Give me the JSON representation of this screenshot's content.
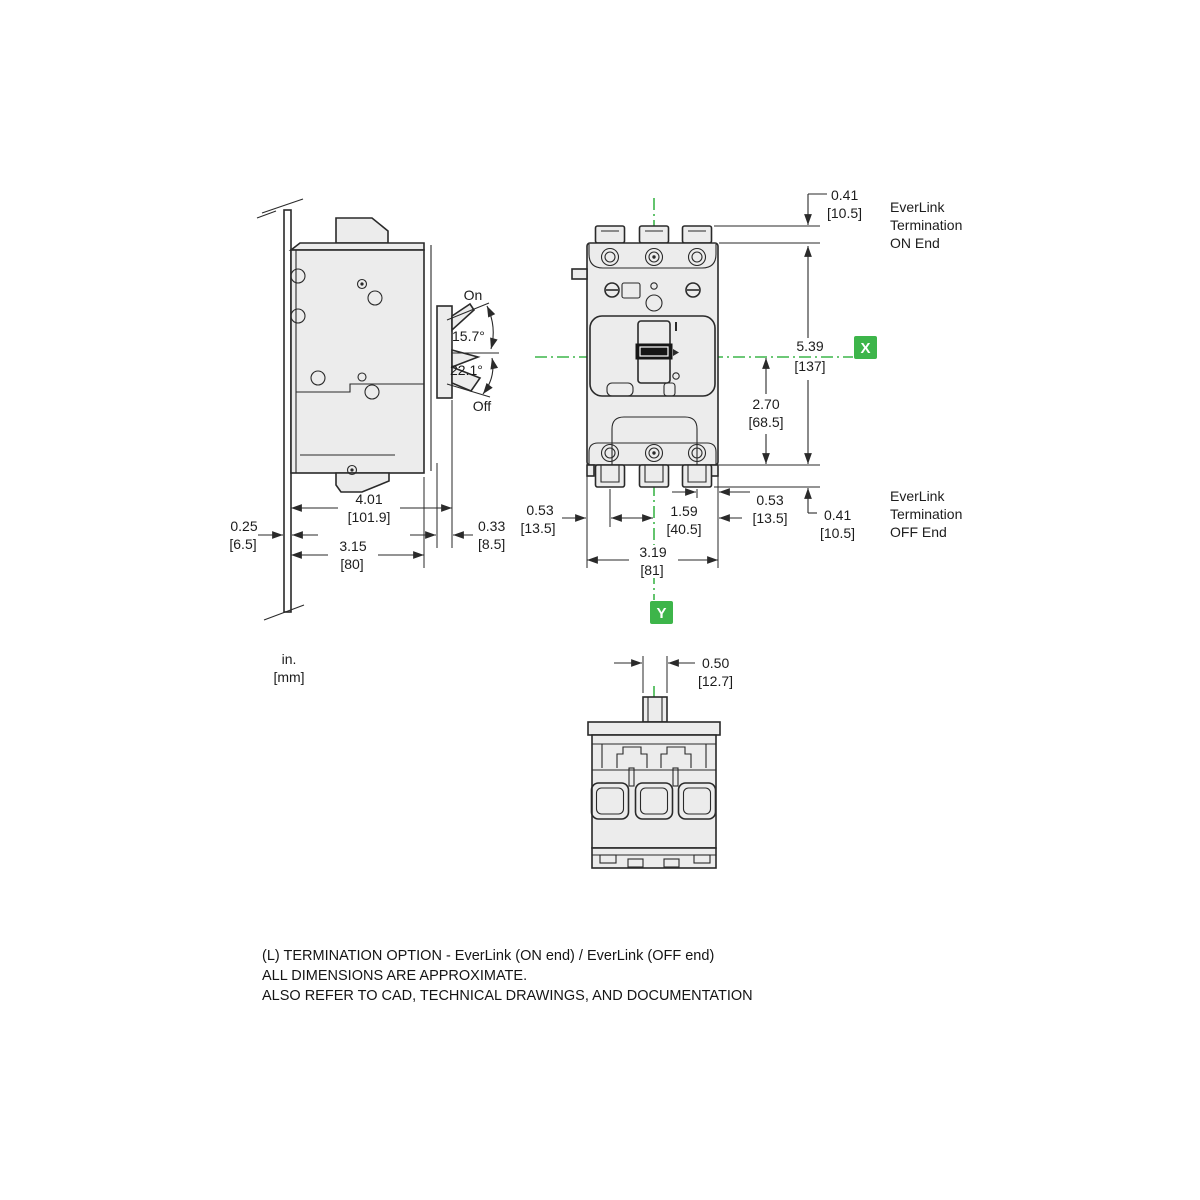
{
  "drawing": {
    "units_label": {
      "line1": "in.",
      "line2": "[mm]"
    },
    "side_view": {
      "handle_on_label": "On",
      "handle_off_label": "Off",
      "angle_on": "15.7°",
      "angle_off": "22.1°",
      "total_depth_in": "4.01",
      "total_depth_mm": "[101.9]",
      "panel_thickness_in": "0.25",
      "panel_thickness_mm": "[6.5]",
      "body_depth_in": "3.15",
      "body_depth_mm": "[80]",
      "escutcheon_depth_in": "0.33",
      "escutcheon_depth_mm": "[8.5]"
    },
    "front_view": {
      "tab_height_top_in": "0.41",
      "tab_height_top_mm": "[10.5]",
      "body_height_in": "5.39",
      "body_height_mm": "[137]",
      "center_to_bottom_in": "2.70",
      "center_to_bottom_mm": "[68.5]",
      "pole_offset_left_in": "0.53",
      "pole_offset_left_mm": "[13.5]",
      "pole_offset_right_in": "0.53",
      "pole_offset_right_mm": "[13.5]",
      "half_width_in": "1.59",
      "half_width_mm": "[40.5]",
      "body_width_in": "3.19",
      "body_width_mm": "[81]",
      "tab_height_bottom_in": "0.41",
      "tab_height_bottom_mm": "[10.5]",
      "axis_x_label": "X",
      "axis_y_label": "Y",
      "on_end_note": {
        "line1": "EverLink",
        "line2": "Termination",
        "line3": "ON End"
      },
      "off_end_note": {
        "line1": "EverLink",
        "line2": "Termination",
        "line3": "OFF End"
      }
    },
    "bottom_view": {
      "handle_width_in": "0.50",
      "handle_width_mm": "[12.7]"
    },
    "footer": {
      "line1": "(L) TERMINATION OPTION - EverLink (ON end) / EverLink (OFF end)",
      "line2": "ALL DIMENSIONS ARE APPROXIMATE.",
      "line3": "ALSO REFER TO CAD, TECHNICAL DRAWINGS, AND DOCUMENTATION"
    },
    "colors": {
      "accent_green": "#3db54a",
      "line": "#2a2a2a"
    }
  }
}
